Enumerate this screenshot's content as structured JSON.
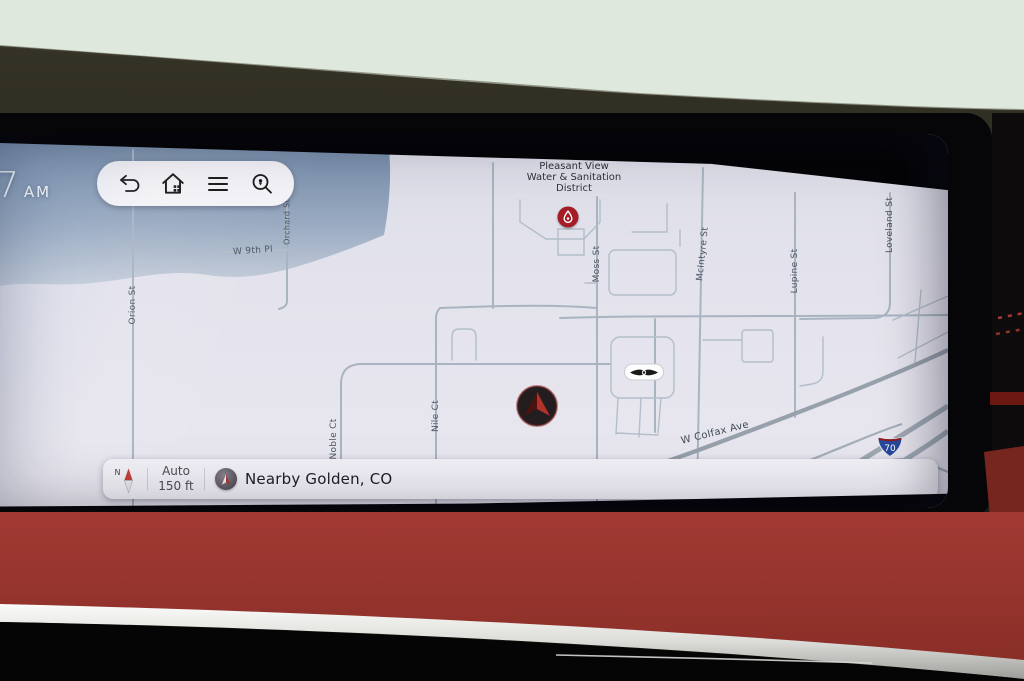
{
  "screen": {
    "time": {
      "hour": "7",
      "meridiem": "AM"
    },
    "toolbar": {
      "icons": [
        "back-icon",
        "home-icon",
        "menu-icon",
        "search-location-icon"
      ]
    },
    "map": {
      "poi_lines": [
        "Pleasant View",
        "Water & Sanitation",
        "District"
      ],
      "poi_marker": "water-utility-pin",
      "streets": [
        {
          "name": "Orion St"
        },
        {
          "name": "Orchard St"
        },
        {
          "name": "W 9th Pl"
        },
        {
          "name": "Moss St"
        },
        {
          "name": "McIntyre St"
        },
        {
          "name": "Lupine St"
        },
        {
          "name": "Loveland St"
        },
        {
          "name": "Nile Ct"
        },
        {
          "name": "Noble Ct"
        },
        {
          "name": "W Colfax Ave"
        }
      ],
      "highway_shield": {
        "system": "Interstate",
        "route": "70"
      },
      "dealer_badge": "genesis-wings-logo",
      "vehicle_marker": "navigation-arrow"
    },
    "status_bar": {
      "compass": "N",
      "zoom_mode": "Auto",
      "scale": "150 ft",
      "location": "Nearby Golden, CO"
    }
  },
  "colors": {
    "map_background": "#e3e2ec",
    "road_line": "#a8b5c1",
    "poi_red": "#a31c26",
    "interstate_blue": "#27489c",
    "interstate_red": "#8f1d22",
    "marker_red": "#b23128",
    "dash_leather_red": "#9c3a33",
    "chrome_trim": "#e9e9e5"
  }
}
